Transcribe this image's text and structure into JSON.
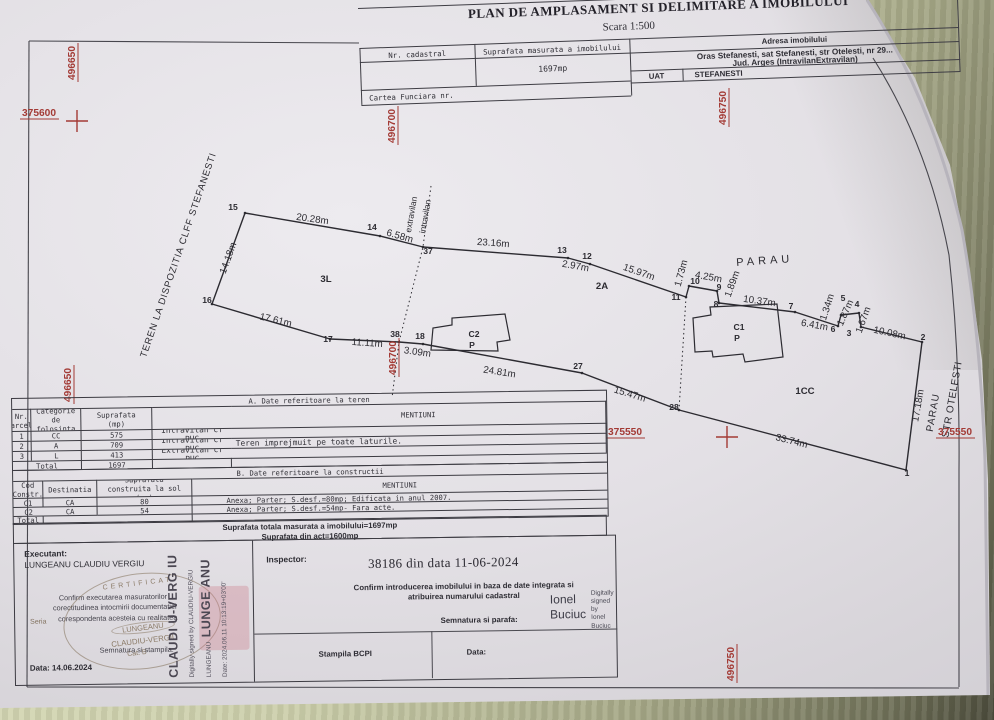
{
  "header": {
    "title": "PLAN DE AMPLASAMENT SI DELIMITARE A IMOBILULUI",
    "scale": "Scara 1:500",
    "nr_cadastral_label": "Nr. cadastral",
    "suprafata_label": "Suprafata masurata a imobilului",
    "suprafata_value": "1697mp",
    "adresa_label": "Adresa imobilului",
    "adresa_line1": "Oras Stefanesti, sat Stefanesti, str Otelesti, nr 29...",
    "adresa_line2": "Jud. Arges (IntravilanExtravilan)",
    "uat_label": "UAT",
    "uat_value": "STEFANESTI",
    "carte_funciara_label": "Cartea Funciara nr."
  },
  "map": {
    "boundary": "245,213 380,236 423,247 568,258 590,264 686,297 689,286 717,291 719,303 795,312 838,326 841,315 859,313 861,327 922,342 906,470 679,410 582,373 423,344 399,342 330,339 212,304",
    "buildings": [
      {
        "name": "C2",
        "points": "431,350 433,328 452,325 452,318 505,314 510,340 497,342 498,351"
      },
      {
        "name": "C1",
        "points": "695,352 693,318 711,315 710,307 777,304 783,357 745,362 743,354 713,357 712,351"
      }
    ],
    "dotted": [
      "431,186 423,247 399,342 392,398",
      "686,297 679,410"
    ],
    "dims": [
      [
        "20.28m",
        312,
        222,
        8
      ],
      [
        "6.58m",
        399,
        239,
        16
      ],
      [
        "23.16m",
        493,
        246,
        4
      ],
      [
        "2.97m",
        575,
        269,
        10
      ],
      [
        "15.97m",
        638,
        275,
        19
      ],
      [
        "1.73m",
        684,
        274,
        -75
      ],
      [
        "4.25m",
        708,
        280,
        10
      ],
      [
        "1.89m",
        735,
        285,
        -70
      ],
      [
        "10.37m",
        759,
        304,
        8
      ],
      [
        "6.41m",
        814,
        328,
        10
      ],
      [
        "1.34m",
        830,
        308,
        -72
      ],
      [
        "1.87m",
        848,
        314,
        -66
      ],
      [
        "1.67m",
        866,
        321,
        -70
      ],
      [
        "10.08m",
        889,
        336,
        12
      ],
      [
        "17.18m",
        921,
        406,
        -80
      ],
      [
        "33.74m",
        791,
        444,
        14
      ],
      [
        "15.47m",
        629,
        397,
        17
      ],
      [
        "24.81m",
        499,
        375,
        9
      ],
      [
        "3.09m",
        417,
        355,
        8
      ],
      [
        "11.11m",
        367,
        346,
        4
      ],
      [
        "17.61m",
        275,
        323,
        13
      ],
      [
        "14.18m",
        231,
        259,
        -70
      ]
    ],
    "points": [
      [
        "15",
        233,
        210
      ],
      [
        "14",
        372,
        230
      ],
      [
        "37",
        428,
        254
      ],
      [
        "13",
        562,
        253
      ],
      [
        "12",
        587,
        259
      ],
      [
        "11",
        676,
        300
      ],
      [
        "10",
        695,
        284
      ],
      [
        "9",
        719,
        290
      ],
      [
        "8",
        716,
        307
      ],
      [
        "7",
        791,
        309
      ],
      [
        "6",
        833,
        332
      ],
      [
        "5",
        843,
        301
      ],
      [
        "4",
        857,
        307
      ],
      [
        "3",
        849,
        336
      ],
      [
        "2",
        923,
        340
      ],
      [
        "1",
        907,
        476
      ],
      [
        "28",
        674,
        410
      ],
      [
        "27",
        578,
        369
      ],
      [
        "18",
        420,
        339
      ],
      [
        "38",
        395,
        337
      ],
      [
        "17",
        328,
        342
      ],
      [
        "16",
        207,
        303
      ]
    ],
    "areas": [
      [
        "3L",
        326,
        282
      ],
      [
        "2A",
        602,
        289
      ],
      [
        "1CC",
        805,
        394
      ]
    ],
    "building_labels": [
      [
        "C2",
        474,
        337
      ],
      [
        "P",
        472,
        348
      ],
      [
        "C1",
        739,
        330
      ],
      [
        "P",
        737,
        341
      ]
    ],
    "misc": [
      {
        "t": "PARAU",
        "x": 765,
        "y": 264,
        "r": -4,
        "ls": 4,
        "fs": 11
      },
      {
        "t": "PARAU",
        "x": 936,
        "y": 413,
        "r": -80,
        "ls": 1,
        "fs": 10
      },
      {
        "t": "STR OTELESTI",
        "x": 955,
        "y": 400,
        "r": -80,
        "ls": 0.5,
        "fs": 10
      },
      {
        "t": "extravilan",
        "x": 414,
        "y": 215,
        "r": -80,
        "ls": 0,
        "fs": 8.5
      },
      {
        "t": "intravilan",
        "x": 428,
        "y": 217,
        "r": -80,
        "ls": 0,
        "fs": 8.5
      },
      {
        "t": "TEREN LA DISPOZITIA CLFF STEFANESTI",
        "x": 181,
        "y": 256,
        "r": -71,
        "ls": 0.8,
        "fs": 9.5
      }
    ],
    "grid_labels": [
      {
        "t": "496650",
        "x": 75,
        "y": 80,
        "r": -90
      },
      {
        "t": "496650",
        "x": 71,
        "y": 402,
        "r": -90
      },
      {
        "t": "496700",
        "x": 395,
        "y": 143,
        "r": -90
      },
      {
        "t": "496700",
        "x": 396,
        "y": 375,
        "r": -90
      },
      {
        "t": "496750",
        "x": 726,
        "y": 125,
        "r": -90
      },
      {
        "t": "496750",
        "x": 734,
        "y": 681,
        "r": -90
      },
      {
        "t": "375600",
        "x": 22,
        "y": 116,
        "r": 0
      },
      {
        "t": "375550",
        "x": 608,
        "y": 435,
        "r": 0
      },
      {
        "t": "375550",
        "x": 938,
        "y": 435,
        "r": 0
      }
    ],
    "crosses": [
      [
        77,
        121
      ],
      [
        727,
        437
      ]
    ]
  },
  "table_a": {
    "title": "A. Date referitoare la teren",
    "headers": [
      "Nr.\nparcela",
      "Categorie de\nfolosinta",
      "Suprafata\n(mp)",
      "",
      "MENTIUNI"
    ],
    "rows": [
      [
        "1",
        "CC",
        "575",
        "Intravilan cf PUG",
        ""
      ],
      [
        "2",
        "A",
        "709",
        "Intravilan cf PUG",
        "Teren imprejmuit pe toate laturile."
      ],
      [
        "3",
        "L",
        "413",
        "Extravilan cf PUG",
        ""
      ]
    ],
    "total_label": "Total",
    "total_value": "1697"
  },
  "table_b": {
    "title": "B. Date referitoare la constructii",
    "headers": [
      "Cod\nConstr.",
      "Destinatia",
      "Suprafata\nconstruita la sol\n(mp)",
      "MENTIUNI"
    ],
    "rows": [
      [
        "C1",
        "CA",
        "80",
        "Anexa; Parter; S.desf.=80mp; Edificata in anul 2007."
      ],
      [
        "C2",
        "CA",
        "54",
        "Anexa; Parter; S.desf.=54mp- Fara acte."
      ]
    ],
    "total_label": "Total"
  },
  "summary": {
    "line1": "Suprafata totala masurata a imobilului=1697mp",
    "line2": "Suprafata din act=1600mp"
  },
  "executant": {
    "label": "Executant:",
    "name": "LUNGEANU CLAUDIU VERGIU",
    "confirm_line1": "Confirm executarea masuratorilor",
    "confirm_line2": "corectitudinea intocmirii documentatiei",
    "confirm_line3": "corespondenta acesteia cu realitatea",
    "seria": "Seria",
    "stamp_cert": "CERTIFICAT",
    "stamp_name1": "LUNGEANU",
    "stamp_name2": "CLAUDIU-VERGIU",
    "stamp_cat": "Cat. B",
    "semnatura_label": "Semnatura si stampila.",
    "date_label": "Data: 14.06.2024",
    "dsig_big1": "CLAUDI U-VERG IU",
    "dsig_small1": "Digitally signed by CLAUDIU-VERGIU LUNGEANU",
    "dsig_big2": "LUNGE ANU",
    "dsig_small2": "Date: 2024.06.11 10:13:19+03'00'"
  },
  "inspector": {
    "label": "Inspector:",
    "registration": "38186 din data 11-06-2024",
    "confirm_line1": "Confirm introducerea imobilului in baza de date integrata si",
    "confirm_line2": "atribuirea numarului cadastral",
    "semnatura_label": "Semnatura si parafa:",
    "stampila_label": "Stampila BCPI",
    "date_label": "Data:",
    "signature_name": "Ionel\nBuciuc",
    "signature_note": "Digitally\nsigned by\nIonel Buciuc"
  }
}
